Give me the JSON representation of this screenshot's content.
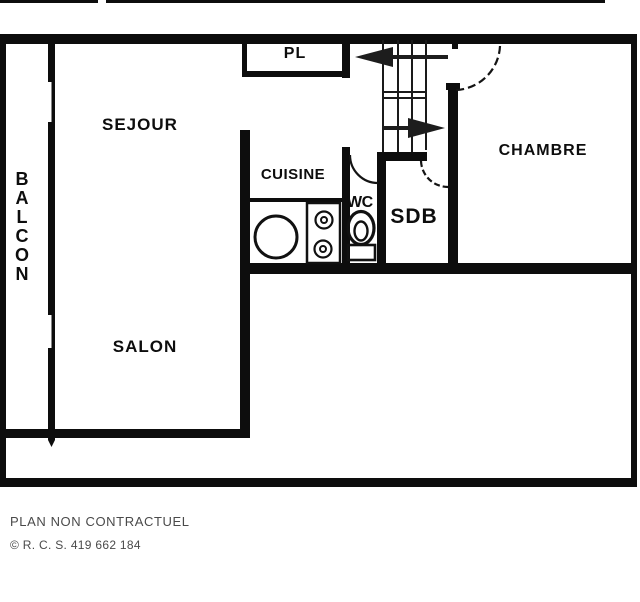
{
  "plan": {
    "rooms": {
      "sejour": "SEJOUR",
      "balcon": "BALCON",
      "closet": "PL",
      "cuisine": "CUISINE",
      "wc": "WC",
      "sdb": "SDB",
      "chambre": "CHAMBRE",
      "salon": "SALON"
    },
    "fixtures": {
      "sink": "sink-icon",
      "stove": "stove-icon",
      "toilet": "toilet-icon",
      "stairs": "staircase-icon",
      "arrows": [
        "arrow-left-icon",
        "arrow-right-icon"
      ]
    },
    "colors": {
      "wall": "#0d0d0d",
      "background": "#ffffff",
      "footer_text": "#4a4a4a"
    }
  },
  "footer": {
    "disclaimer": "PLAN NON CONTRACTUEL",
    "registration": "© R. C. S. 419 662 184"
  }
}
